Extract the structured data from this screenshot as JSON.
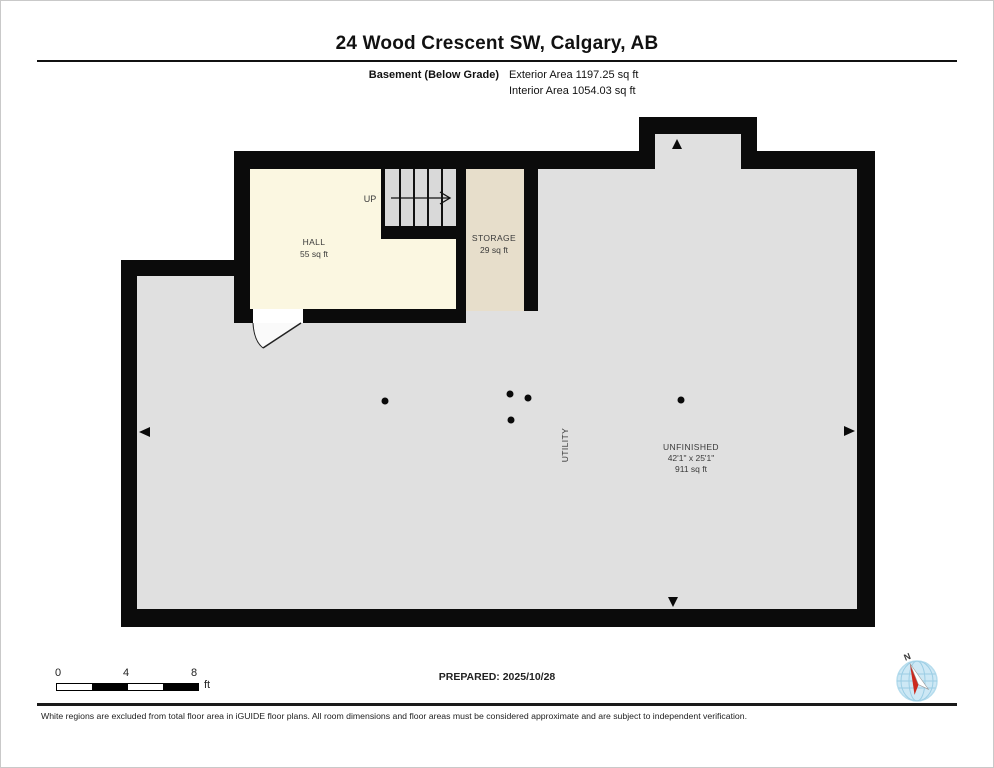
{
  "header": {
    "title": "24 Wood Crescent SW, Calgary, AB",
    "floor_label": "Basement (Below Grade)",
    "exterior_area": "Exterior Area 1197.25 sq ft",
    "interior_area": "Interior Area 1054.03 sq ft"
  },
  "plan": {
    "stair_label": "UP",
    "rooms": [
      {
        "name": "HALL",
        "area": "55 sq ft"
      },
      {
        "name": "STORAGE",
        "area": "29 sq ft"
      },
      {
        "name": "UTILITY"
      },
      {
        "name": "UNFINISHED",
        "dimensions": "42'1\" x 25'1\"",
        "area": "911 sq ft"
      }
    ],
    "colors": {
      "wall": "#0b0b0b",
      "floor": "#e0e0e0",
      "hall": "#fbf7e1",
      "storage": "#e7decb",
      "stairs": "#d9d9d9",
      "compass_blue": "#cde8f5",
      "compass_red": "#cc2a1e"
    }
  },
  "footer": {
    "scale": {
      "tick0": "0",
      "tick1": "4",
      "tick2": "8",
      "unit": "ft"
    },
    "prepared": "PREPARED: 2025/10/28",
    "compass_label": "N",
    "disclaimer": "White regions are excluded from total floor area in iGUIDE floor plans. All room dimensions and floor areas must be considered approximate and are subject to independent verification."
  }
}
